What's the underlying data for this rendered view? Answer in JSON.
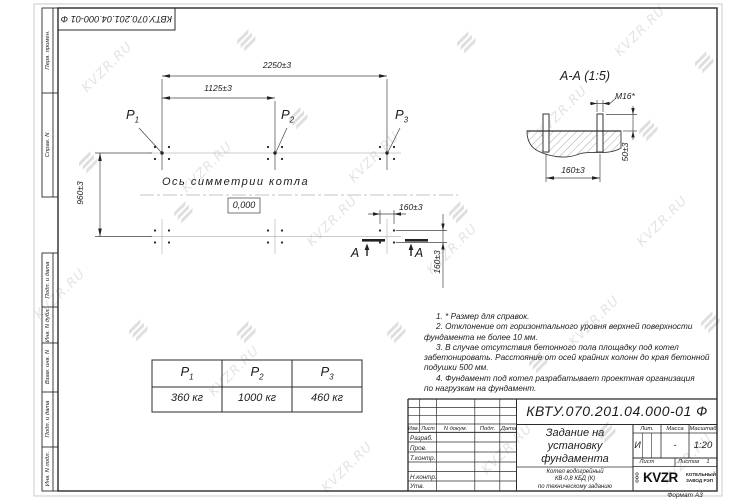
{
  "watermark": {
    "text": "KVZR.RU"
  },
  "corner_stamp": {
    "doc_number": "КВТУ.070.201.04.000-01 Ф"
  },
  "side_stamps": {
    "top": [
      {
        "label": "Перв. примен."
      },
      {
        "label": "Справ. N"
      }
    ],
    "bottom": [
      {
        "label": "Подп. и дата"
      },
      {
        "label": "Инв. N дубл."
      },
      {
        "label": "Взам. инв. N"
      },
      {
        "label": "Подп. и дата"
      },
      {
        "label": "Инв. N подл."
      }
    ]
  },
  "plan": {
    "dim_total": "2250±3",
    "dim_half": "1125±3",
    "dim_height": "960±3",
    "dim_bolt_x": "160±3",
    "dim_bolt_y": "160±3",
    "p_labels": [
      {
        "base": "P",
        "sub": "1"
      },
      {
        "base": "P",
        "sub": "2"
      },
      {
        "base": "P",
        "sub": "3"
      }
    ],
    "axis_label": "Ось симметрии котла",
    "level_mark": "0,000",
    "section_letter": "А"
  },
  "section": {
    "title": "А-А (1:5)",
    "thread_label": "М16*",
    "dim_height": "50±3",
    "dim_width": "160±3"
  },
  "notes": {
    "lines": [
      "1. * Размер для справок.",
      "2. Отклонение от горизонтального уровня верхней поверхности",
      "фундамента не более 10 мм.",
      "3. В случае отсутствия бетонного пола площадку под котел",
      "забетонировать. Расстояние от осей крайних колонн до края бетонной",
      "подушки 500 мм.",
      "4. Фундамент под котел разрабатывает проектная организация",
      "по нагрузкам на фундамент."
    ]
  },
  "loads_table": {
    "headers": [
      {
        "base": "P",
        "sub": "1"
      },
      {
        "base": "P",
        "sub": "2"
      },
      {
        "base": "P",
        "sub": "3"
      }
    ],
    "values": [
      "360 кг",
      "1000 кг",
      "460 кг"
    ]
  },
  "title_block": {
    "doc_number": "КВТУ.070.201.04.000-01 Ф",
    "title_lines": [
      "Задание на",
      "установку",
      "фундамента"
    ],
    "object_lines": [
      "Котел водогрейный",
      "КВ-0,8 КБД (К)",
      "по техническому заданию"
    ],
    "rev_headers": [
      "Изм.",
      "Лист",
      "N докум.",
      "Подп.",
      "Дата"
    ],
    "row_labels": [
      "Разраб.",
      "Пров.",
      "Т.контр.",
      "Н.контр.",
      "Утв."
    ],
    "lit_header": "Лит.",
    "lit_value": "И",
    "mass_header": "Масса",
    "mass_value": "-",
    "scale_header": "Масштаб",
    "scale_value": "1:20",
    "sheet_label": "Лист",
    "sheets_label": "Листов",
    "sheets_value": "1",
    "company": {
      "prefix": "ООО",
      "name": "KVZR",
      "line1": "КОТЕЛЬНЫЙ",
      "line2": "ЗАВОД РЭП"
    },
    "format_label": "Формат А3"
  }
}
